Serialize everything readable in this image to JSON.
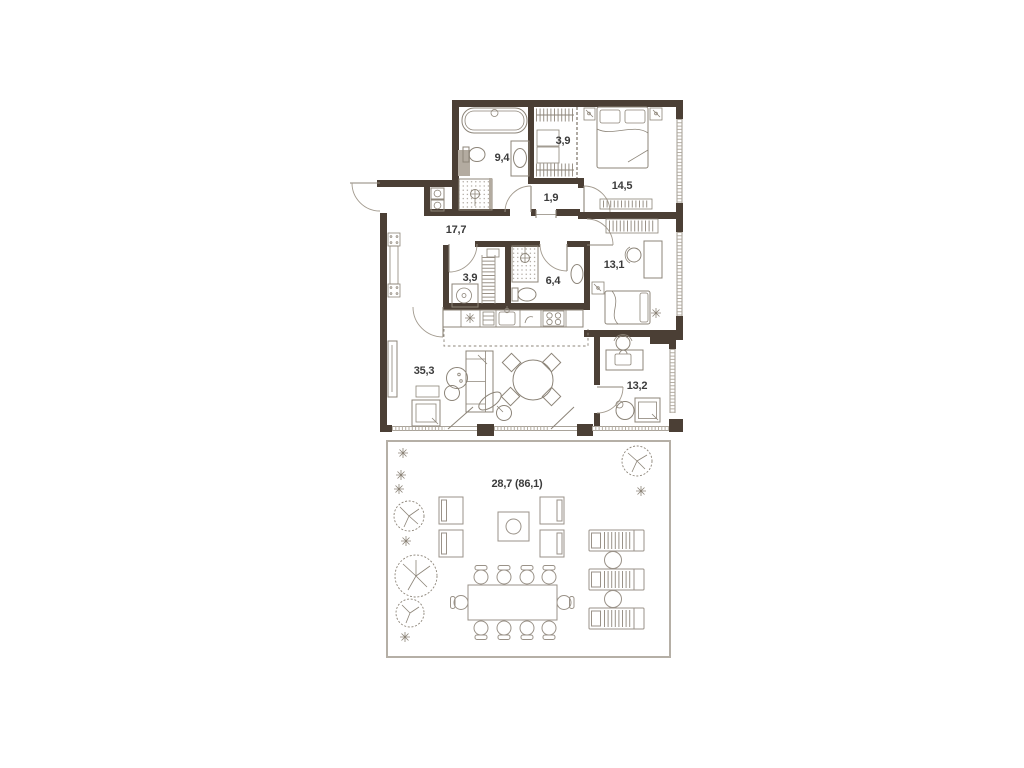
{
  "plan": {
    "type": "apartment-floor-plan-with-terrace",
    "rooms": [
      {
        "name": "bathroom",
        "area": "9,4"
      },
      {
        "name": "wardrobe",
        "area": "3,9"
      },
      {
        "name": "bedroom",
        "area": "14,5"
      },
      {
        "name": "hall",
        "area": "1,9"
      },
      {
        "name": "entry-hall",
        "area": "17,7"
      },
      {
        "name": "laundry",
        "area": "3,9"
      },
      {
        "name": "shower-room",
        "area": "6,4"
      },
      {
        "name": "bedroom-2",
        "area": "13,1"
      },
      {
        "name": "living-kitchen",
        "area": "35,3"
      },
      {
        "name": "cabinet",
        "area": "13,2"
      },
      {
        "name": "terrace",
        "area": "28,7 (86,1)"
      }
    ],
    "colors": {
      "wall": "#4b3f35",
      "furniture_line": "#8c8478",
      "window_tick": "#b6afa4",
      "terrace_border": "#b5afa6",
      "label_text": "#3b3b3b",
      "background": "#ffffff"
    }
  }
}
